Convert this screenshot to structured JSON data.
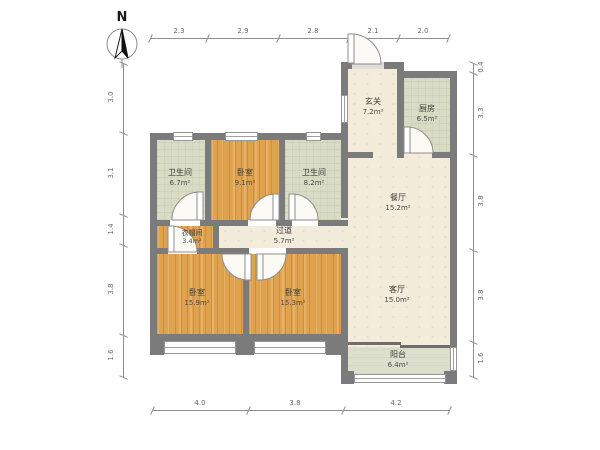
{
  "compass": {
    "label": "N"
  },
  "rooms": [
    {
      "key": "bathroom-1",
      "name": "卫生间",
      "area": "6.7m²"
    },
    {
      "key": "bedroom-top",
      "name": "卧室",
      "area": "9.1m²"
    },
    {
      "key": "bathroom-2",
      "name": "卫生间",
      "area": "8.2m²"
    },
    {
      "key": "entry",
      "name": "玄关",
      "area": "7.2m²"
    },
    {
      "key": "kitchen",
      "name": "厨房",
      "area": "6.5m²"
    },
    {
      "key": "dining",
      "name": "餐厅",
      "area": "15.2m²"
    },
    {
      "key": "cloakroom",
      "name": "衣帽间",
      "area": "3.4m²"
    },
    {
      "key": "hallway",
      "name": "过道",
      "area": "5.7m²"
    },
    {
      "key": "bedroom-left",
      "name": "卧室",
      "area": "15.9m²"
    },
    {
      "key": "bedroom-middle",
      "name": "卧室",
      "area": "15.3m²"
    },
    {
      "key": "living",
      "name": "客厅",
      "area": "15.0m²"
    },
    {
      "key": "balcony",
      "name": "阳台",
      "area": "6.4m²"
    }
  ],
  "dims": {
    "top": [
      "2.3",
      "2.9",
      "2.8",
      "2.1",
      "2.0"
    ],
    "bottom": [
      "4.0",
      "3.8",
      "4.2"
    ],
    "left": [
      "3.0",
      "3.1",
      "1.4",
      "3.8",
      "1.6"
    ],
    "right": [
      "0.4",
      "3.3",
      "3.8",
      "3.8",
      "1.6"
    ]
  },
  "colors": {
    "wall": "#7b7b7b",
    "wood_floor": "#dfa24e",
    "tile_floor": "#d9dcc4",
    "cream_floor": "#f3ecda",
    "balcony_floor": "#dcdfcc"
  }
}
